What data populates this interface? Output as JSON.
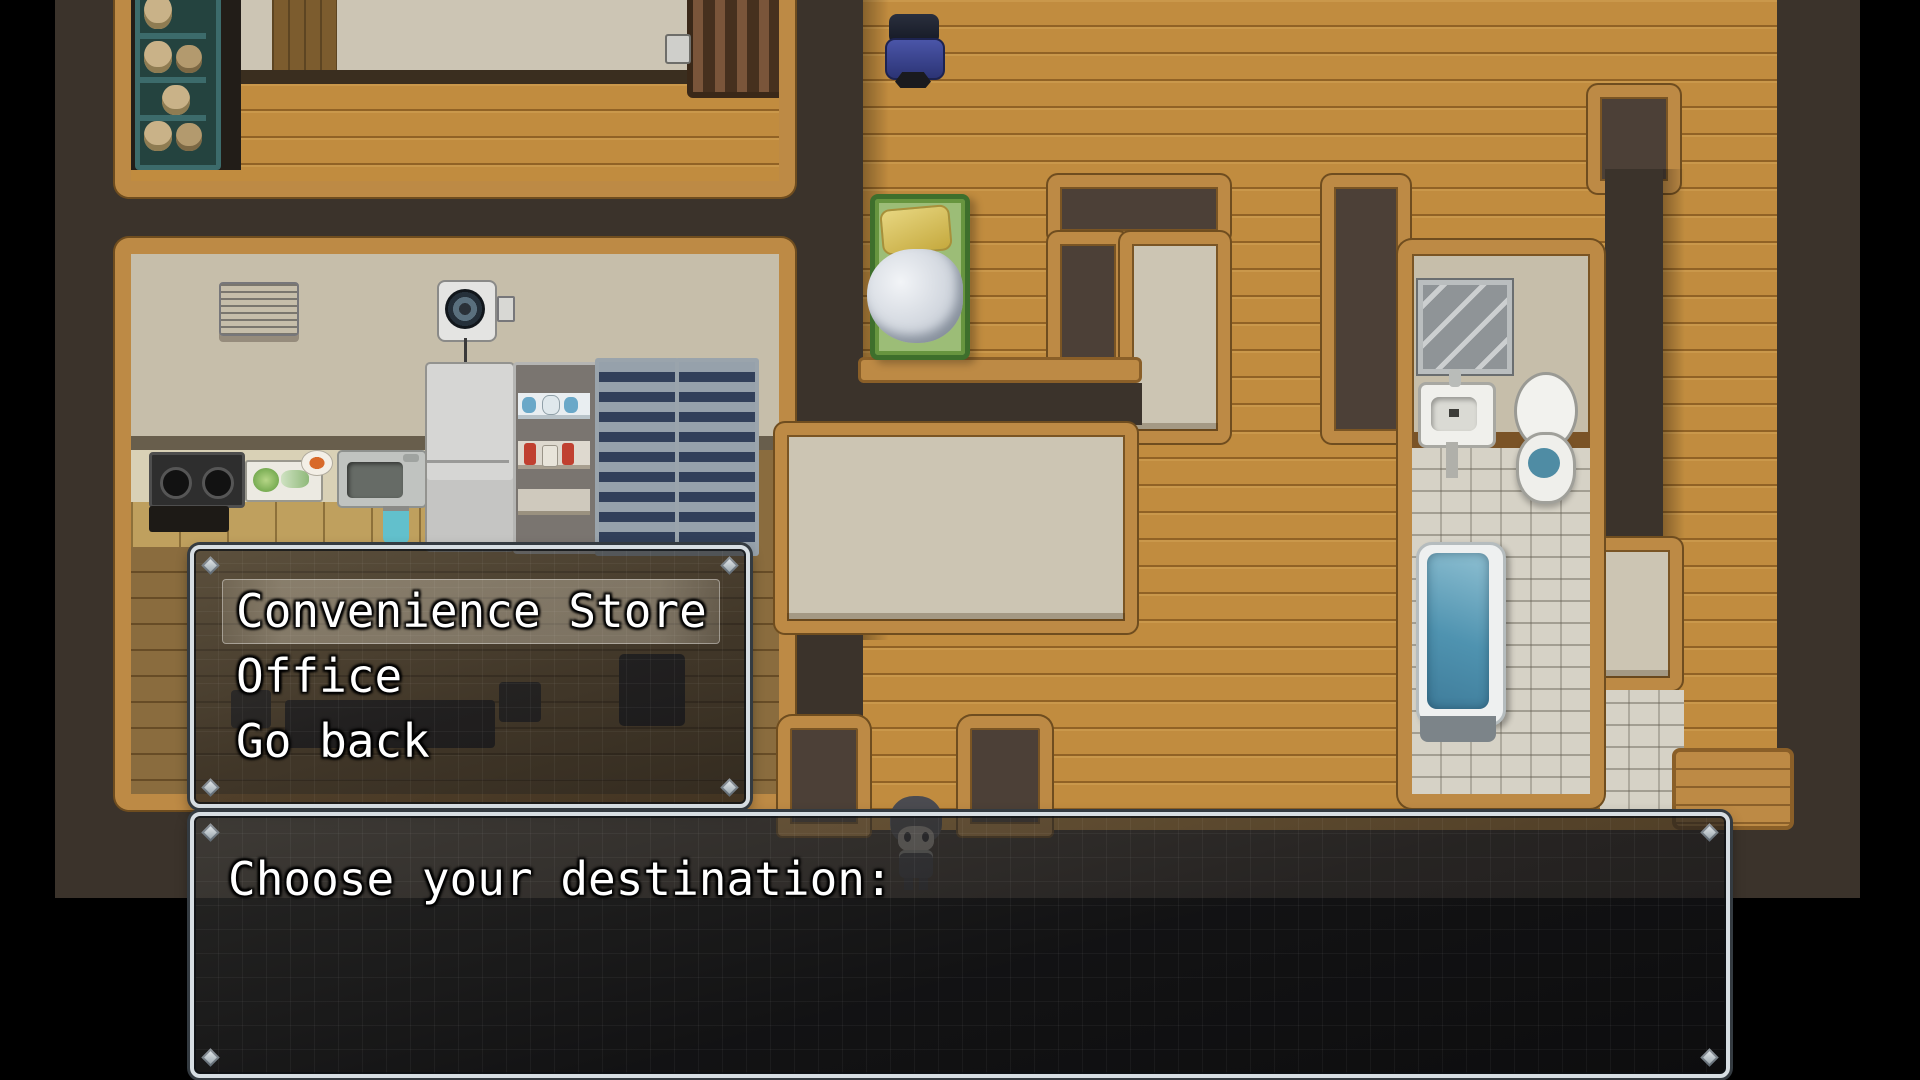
{
  "message_window": {
    "text": "Choose your destination:"
  },
  "choice_window": {
    "options": [
      {
        "label": "Convenience Store",
        "selected": true
      },
      {
        "label": "Office",
        "selected": false
      },
      {
        "label": "Go back",
        "selected": false
      }
    ]
  },
  "colors": {
    "window_border": "#d7dee3",
    "window_background": "rgba(28,28,30,0.62)",
    "selection_highlight": "rgba(255,246,226,0.30)",
    "text": "#ffffff",
    "floor_wood": "#c18c3f",
    "wall_frame": "#bd8a45",
    "wall_top_dark": "#4c4037",
    "wall_top_beige": "#ccc5b3",
    "backdrop": "#3b332b",
    "bathroom_tile": "#d6d2c6",
    "water": "#4f93b0",
    "bed_green": "#67953f",
    "pillow_yellow": "#d9c35a",
    "chair_blue": "#3d4796"
  },
  "map": {
    "rooms": [
      "storage-room",
      "kitchen-room",
      "bedroom-alcove",
      "bathroom",
      "corridor-maze"
    ],
    "furniture": [
      "storage-shelf",
      "wooden-crib",
      "office-chair",
      "bed",
      "air-conditioner",
      "ventilation-fan",
      "gas-stove",
      "cutting-board",
      "kitchen-sink",
      "refrigerator",
      "dish-cabinet",
      "display-cabinets",
      "office-desk",
      "desk-chairs",
      "wall-mirror",
      "hand-sink",
      "toilet",
      "bathtub"
    ],
    "player": "chibi-character"
  }
}
